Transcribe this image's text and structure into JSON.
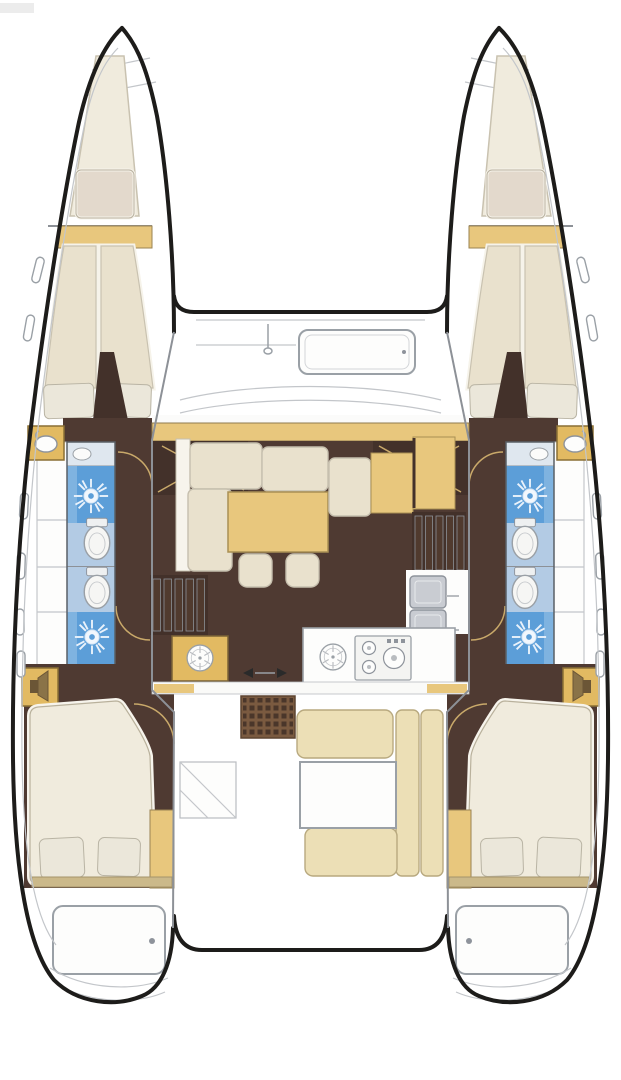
{
  "page": {
    "width": 621,
    "height": 1080,
    "background": "#ffffff"
  },
  "colors": {
    "outline": "#1d1c1a",
    "wallGray": "#8d9197",
    "lineGray": "#9aa0a6",
    "lineLight": "#c3c6ca",
    "doorArc": "#c9a96a",
    "cream": "#e9e1cd",
    "creamLight": "#f0ebdd",
    "creamRim": "#f7f4ec",
    "pillow": "#ebe7da",
    "tanWood": "#e8c77d",
    "vanityTan": "#e2ba62",
    "cockpitTan": "#ecdfb6",
    "khaki": "#cbb98a",
    "brownFloor": "#4f3a32",
    "brownDark": "#43312a",
    "brownGrid": "#7a5a40",
    "gridDot": "#4a362a",
    "blueShower": "#5c9ed8",
    "blueShowerLight": "#7fb3e0",
    "blueFloor": "#b3cbe4",
    "applianceGray": "#c9ccd2",
    "stepsDark": "#503a2e",
    "white": "#fdfdfc",
    "artifact": "#ececec"
  },
  "diagram": {
    "kind": "Catamaran yacht interior floor plan, top-down view",
    "hull_count": 2,
    "areas": [
      {
        "name": "foredeck",
        "items": [
          "forward crossbeam",
          "deck hatch",
          "mast step"
        ]
      },
      {
        "name": "port hull",
        "items": [
          "bow anchor locker",
          "forward berth with pillow",
          "shelf",
          "v-berth with 2 pillows",
          "vanity basin",
          "shower with shower rose",
          "toilet",
          "second toilet",
          "second shower with shower rose",
          "locker",
          "aft double berth with 2 pillows",
          "wardrobe",
          "transom steps hatch"
        ]
      },
      {
        "name": "starboard hull",
        "items": [
          "bow anchor locker",
          "forward berth with pillow",
          "shelf",
          "v-berth with 2 pillows",
          "vanity basin",
          "shower with shower rose",
          "toilet",
          "second toilet",
          "second shower with shower rose",
          "locker",
          "aft double berth with 2 pillows",
          "wardrobe",
          "transom steps hatch"
        ]
      },
      {
        "name": "saloon",
        "items": [
          "L-shaped settee",
          "dining table",
          "two footstools",
          "nav seat",
          "nav desk",
          "steps to port hull",
          "steps to starboard hull"
        ]
      },
      {
        "name": "galley",
        "items": [
          "round sink",
          "stove with three burners",
          "refrigerator units",
          "cabinet with round sink",
          "sliding door arrows"
        ]
      },
      {
        "name": "cockpit",
        "items": [
          "grate table",
          "U-shaped bench seating",
          "cockpit table",
          "side locker",
          "aft crossbeam",
          "transom step curves"
        ]
      }
    ],
    "icons": [
      "shower-rose-icon",
      "toilet-icon",
      "round-sink-icon",
      "stove-burners-icon",
      "basin-faucet-icon",
      "speaker-locker-icon",
      "slide-arrows-icon",
      "porthole-icon",
      "deck-hatch-icon"
    ]
  }
}
